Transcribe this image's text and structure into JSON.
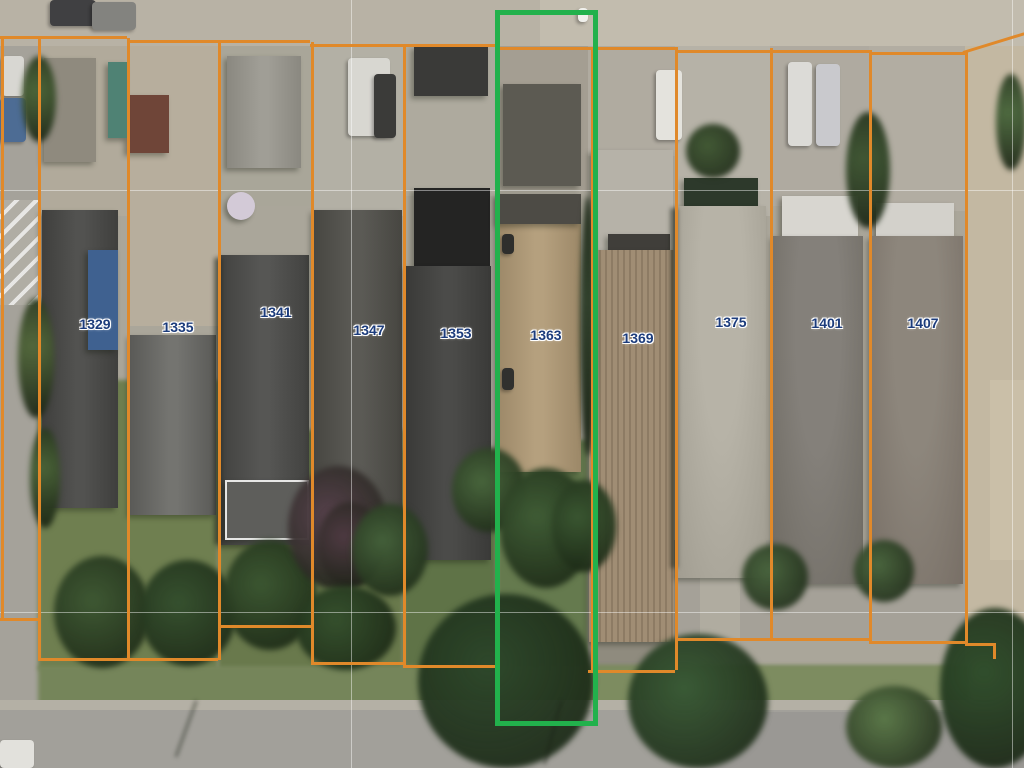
{
  "map": {
    "type": "aerial-parcel-view",
    "description": "aerial photo of residential block with parcel boundary overlay",
    "parcel_line_color": "#e0892a",
    "highlight_color": "#22b14c",
    "label_color": "#1c3c7c",
    "graticule_color": "rgba(255,255,255,0.45)",
    "highlighted_lot": "1363",
    "lots": [
      {
        "number": "1329",
        "label_x": 95,
        "label_y": 324
      },
      {
        "number": "1335",
        "label_x": 178,
        "label_y": 327
      },
      {
        "number": "1341",
        "label_x": 276,
        "label_y": 312
      },
      {
        "number": "1347",
        "label_x": 369,
        "label_y": 330
      },
      {
        "number": "1353",
        "label_x": 456,
        "label_y": 333
      },
      {
        "number": "1363",
        "label_x": 546,
        "label_y": 335
      },
      {
        "number": "1369",
        "label_x": 638,
        "label_y": 338
      },
      {
        "number": "1375",
        "label_x": 731,
        "label_y": 322
      },
      {
        "number": "1401",
        "label_x": 827,
        "label_y": 323
      },
      {
        "number": "1407",
        "label_x": 923,
        "label_y": 323
      }
    ],
    "highlight_box": {
      "x": 495,
      "y": 10,
      "w": 93,
      "h": 706,
      "stroke": 5
    }
  },
  "scene": {
    "patches": [
      {
        "x": 0,
        "y": 0,
        "w": 1024,
        "h": 46,
        "c": "#b8b2a5"
      },
      {
        "x": 540,
        "y": 0,
        "w": 484,
        "h": 48,
        "c": "#c2bcae"
      },
      {
        "x": 0,
        "y": 46,
        "w": 40,
        "h": 660,
        "c": "#a5a29a"
      },
      {
        "x": 0,
        "y": 200,
        "w": 38,
        "h": 105,
        "c": "#b0ada4",
        "stripes": true
      },
      {
        "x": 965,
        "y": 46,
        "w": 59,
        "h": 700,
        "c": "#c3b8a2"
      },
      {
        "x": 990,
        "y": 380,
        "w": 34,
        "h": 180,
        "c": "#cabfa8"
      },
      {
        "x": 40,
        "y": 46,
        "w": 88,
        "h": 170,
        "c": "#b1aa9b"
      },
      {
        "x": 128,
        "y": 46,
        "w": 90,
        "h": 280,
        "c": "#b7ae9d"
      },
      {
        "x": 218,
        "y": 46,
        "w": 93,
        "h": 160,
        "c": "#a9a699"
      },
      {
        "x": 311,
        "y": 46,
        "w": 92,
        "h": 170,
        "c": "#b3b0a5"
      },
      {
        "x": 403,
        "y": 46,
        "w": 94,
        "h": 150,
        "c": "#aeaa9e"
      },
      {
        "x": 497,
        "y": 46,
        "w": 91,
        "h": 145,
        "c": "#a49e92"
      },
      {
        "x": 588,
        "y": 46,
        "w": 87,
        "h": 110,
        "c": "#b0aba0"
      },
      {
        "x": 675,
        "y": 46,
        "w": 95,
        "h": 170,
        "c": "#b6b2a7"
      },
      {
        "x": 770,
        "y": 46,
        "w": 99,
        "h": 160,
        "c": "#afaaa0"
      },
      {
        "x": 869,
        "y": 46,
        "w": 96,
        "h": 165,
        "c": "#b2ada2"
      },
      {
        "x": 38,
        "y": 380,
        "w": 180,
        "h": 290,
        "c": "#6f7f50",
        "blur": true
      },
      {
        "x": 218,
        "y": 430,
        "w": 185,
        "h": 240,
        "c": "#69794c",
        "blur": true
      },
      {
        "x": 403,
        "y": 450,
        "w": 94,
        "h": 225,
        "c": "#5f7347",
        "blur": true
      },
      {
        "x": 497,
        "y": 440,
        "w": 91,
        "h": 240,
        "c": "#657a4e",
        "blur": true
      },
      {
        "x": 588,
        "y": 540,
        "w": 87,
        "h": 140,
        "c": "#8f8b7e"
      },
      {
        "x": 675,
        "y": 540,
        "w": 290,
        "h": 100,
        "c": "#a5a198"
      },
      {
        "x": 700,
        "y": 576,
        "w": 40,
        "h": 90,
        "c": "#b0aca0"
      },
      {
        "x": 38,
        "y": 666,
        "w": 930,
        "h": 42,
        "c": "#75855a",
        "blur": true
      },
      {
        "x": 588,
        "y": 666,
        "w": 380,
        "h": 40,
        "c": "#7d8c60",
        "blur": true
      },
      {
        "x": 0,
        "y": 700,
        "w": 1024,
        "h": 12,
        "c": "#b4b0a5"
      },
      {
        "x": 0,
        "y": 710,
        "w": 1024,
        "h": 58,
        "c": "#a2a09a"
      },
      {
        "x": 700,
        "y": 712,
        "w": 324,
        "h": 56,
        "c": "#9a9894"
      }
    ],
    "houses": [
      {
        "x": 44,
        "y": 58,
        "w": 52,
        "h": 104,
        "kind": "flat",
        "c1": "#8f8a7e"
      },
      {
        "x": 42,
        "y": 210,
        "w": 76,
        "h": 298,
        "kind": "gable",
        "c1": "#525250",
        "c2": "#3f3f3d"
      },
      {
        "x": 88,
        "y": 250,
        "w": 30,
        "h": 100,
        "kind": "flat",
        "c1": "#3f6190"
      },
      {
        "x": 127,
        "y": 95,
        "w": 42,
        "h": 58,
        "kind": "flat",
        "c1": "#6f4538"
      },
      {
        "x": 108,
        "y": 62,
        "w": 20,
        "h": 76,
        "kind": "flat",
        "c1": "#4f8274"
      },
      {
        "x": 130,
        "y": 335,
        "w": 86,
        "h": 180,
        "kind": "gable",
        "c1": "#747470",
        "c2": "#5a5a57"
      },
      {
        "x": 227,
        "y": 56,
        "w": 74,
        "h": 112,
        "kind": "gable",
        "c1": "#a09e96",
        "c2": "#8a8880"
      },
      {
        "x": 220,
        "y": 255,
        "w": 89,
        "h": 290,
        "kind": "gable",
        "c1": "#565654",
        "c2": "#424240"
      },
      {
        "x": 225,
        "y": 480,
        "w": 80,
        "h": 56,
        "kind": "flat",
        "c1": "#5e5e5b",
        "border": "2px solid rgba(255,255,255,0.85)"
      },
      {
        "x": 227,
        "y": 192,
        "w": 28,
        "h": 28,
        "kind": "circle",
        "c1": "#d3cad7"
      },
      {
        "x": 313,
        "y": 210,
        "w": 89,
        "h": 342,
        "kind": "gable",
        "c1": "#5b5a55",
        "c2": "#474641"
      },
      {
        "x": 414,
        "y": 46,
        "w": 74,
        "h": 50,
        "kind": "flat",
        "c1": "#3a3a38"
      },
      {
        "x": 414,
        "y": 188,
        "w": 76,
        "h": 78,
        "kind": "flat",
        "c1": "#242423"
      },
      {
        "x": 406,
        "y": 266,
        "w": 85,
        "h": 294,
        "kind": "gable",
        "c1": "#4b4b49",
        "c2": "#3a3a38"
      },
      {
        "x": 503,
        "y": 84,
        "w": 78,
        "h": 102,
        "kind": "flat",
        "c1": "#5c5a52"
      },
      {
        "x": 497,
        "y": 194,
        "w": 84,
        "h": 278,
        "kind": "gable",
        "c1": "#b5a07e",
        "c2": "#9c8868"
      },
      {
        "x": 497,
        "y": 194,
        "w": 84,
        "h": 30,
        "kind": "flat",
        "c1": "#4d4b45"
      },
      {
        "x": 591,
        "y": 150,
        "w": 82,
        "h": 102,
        "kind": "flat",
        "c1": "#b6b2a8"
      },
      {
        "x": 608,
        "y": 234,
        "w": 62,
        "h": 20,
        "kind": "flat",
        "c1": "#403e3a"
      },
      {
        "x": 589,
        "y": 250,
        "w": 85,
        "h": 392,
        "kind": "ribbed",
        "c1": "#a08d74",
        "c2": "#8d7b64"
      },
      {
        "x": 684,
        "y": 178,
        "w": 74,
        "h": 30,
        "kind": "flat",
        "c1": "#2d392b"
      },
      {
        "x": 677,
        "y": 206,
        "w": 89,
        "h": 372,
        "kind": "hip",
        "c1": "#b7b3a7",
        "c2": "#a19d91"
      },
      {
        "x": 782,
        "y": 196,
        "w": 76,
        "h": 42,
        "kind": "flat",
        "c1": "#d8d6d0"
      },
      {
        "x": 773,
        "y": 236,
        "w": 90,
        "h": 348,
        "kind": "hip",
        "c1": "#84807a",
        "c2": "#6f6b63"
      },
      {
        "x": 876,
        "y": 203,
        "w": 78,
        "h": 36,
        "kind": "flat",
        "c1": "#d3d1cb"
      },
      {
        "x": 870,
        "y": 236,
        "w": 93,
        "h": 348,
        "kind": "hip",
        "c1": "#8d867c",
        "c2": "#786f66"
      }
    ],
    "vehicles": [
      {
        "x": 50,
        "y": 0,
        "w": 46,
        "h": 26,
        "c": "#404042"
      },
      {
        "x": 92,
        "y": 2,
        "w": 44,
        "h": 28,
        "c": "#83837f"
      },
      {
        "x": 2,
        "y": 56,
        "w": 22,
        "h": 40,
        "c": "#d8d7d2"
      },
      {
        "x": 0,
        "y": 98,
        "w": 26,
        "h": 44,
        "c": "#4d6c94"
      },
      {
        "x": 348,
        "y": 58,
        "w": 42,
        "h": 78,
        "c": "#d8d7d1"
      },
      {
        "x": 374,
        "y": 74,
        "w": 22,
        "h": 64,
        "c": "#3b3b39"
      },
      {
        "x": 656,
        "y": 70,
        "w": 26,
        "h": 70,
        "c": "#e4e3dd"
      },
      {
        "x": 788,
        "y": 62,
        "w": 24,
        "h": 84,
        "c": "#dcdbd7"
      },
      {
        "x": 816,
        "y": 64,
        "w": 24,
        "h": 82,
        "c": "#c9c9cd"
      },
      {
        "x": 0,
        "y": 740,
        "w": 34,
        "h": 28,
        "c": "#e2e1dc"
      },
      {
        "x": 502,
        "y": 234,
        "w": 12,
        "h": 20,
        "c": "#2e2e2c"
      },
      {
        "x": 502,
        "y": 368,
        "w": 12,
        "h": 22,
        "c": "#30302e"
      },
      {
        "x": 578,
        "y": 8,
        "w": 10,
        "h": 14,
        "c": "#f0f0ec"
      }
    ],
    "trees": [
      {
        "x": 22,
        "y": 56,
        "w": 34,
        "h": 86,
        "c": "#4c6539"
      },
      {
        "x": 18,
        "y": 298,
        "w": 36,
        "h": 120,
        "c": "#53683c"
      },
      {
        "x": 30,
        "y": 428,
        "w": 30,
        "h": 100,
        "c": "#4a6338"
      },
      {
        "x": 54,
        "y": 556,
        "w": 96,
        "h": 112,
        "c": "#3e5833"
      },
      {
        "x": 140,
        "y": 560,
        "w": 96,
        "h": 106,
        "c": "#36512f"
      },
      {
        "x": 224,
        "y": 540,
        "w": 92,
        "h": 110,
        "c": "#3b5631"
      },
      {
        "x": 288,
        "y": 466,
        "w": 100,
        "h": 124,
        "c": "#56414b"
      },
      {
        "x": 318,
        "y": 502,
        "w": 64,
        "h": 86,
        "c": "#4e3a42"
      },
      {
        "x": 352,
        "y": 504,
        "w": 76,
        "h": 92,
        "c": "#44603a"
      },
      {
        "x": 296,
        "y": 586,
        "w": 100,
        "h": 84,
        "c": "#35502d"
      },
      {
        "x": 452,
        "y": 448,
        "w": 74,
        "h": 84,
        "c": "#48653c"
      },
      {
        "x": 500,
        "y": 468,
        "w": 92,
        "h": 120,
        "c": "#3f5c35"
      },
      {
        "x": 552,
        "y": 480,
        "w": 64,
        "h": 92,
        "c": "#3a5631"
      },
      {
        "x": 418,
        "y": 594,
        "w": 176,
        "h": 174,
        "c": "#2e482b"
      },
      {
        "x": 628,
        "y": 634,
        "w": 140,
        "h": 134,
        "c": "#3a5a36"
      },
      {
        "x": 686,
        "y": 124,
        "w": 54,
        "h": 54,
        "c": "#425935"
      },
      {
        "x": 742,
        "y": 544,
        "w": 66,
        "h": 66,
        "c": "#49643e"
      },
      {
        "x": 846,
        "y": 112,
        "w": 44,
        "h": 116,
        "c": "#405734"
      },
      {
        "x": 854,
        "y": 540,
        "w": 60,
        "h": 62,
        "c": "#4a653e"
      },
      {
        "x": 940,
        "y": 608,
        "w": 110,
        "h": 160,
        "c": "#304e2c"
      },
      {
        "x": 846,
        "y": 686,
        "w": 96,
        "h": 82,
        "c": "#5a7748"
      },
      {
        "x": 996,
        "y": 74,
        "w": 30,
        "h": 96,
        "c": "#4e6a40"
      },
      {
        "x": 580,
        "y": 196,
        "w": 16,
        "h": 260,
        "c": "#31402c"
      }
    ],
    "shadows": [
      {
        "x": 195,
        "y": 700,
        "w": 3,
        "h": 60,
        "rot": 20
      },
      {
        "x": 560,
        "y": 700,
        "w": 3,
        "h": 66,
        "rot": 15
      },
      {
        "x": 214,
        "y": 258,
        "w": 8,
        "h": 286,
        "rot": 0
      },
      {
        "x": 670,
        "y": 208,
        "w": 8,
        "h": 360,
        "rot": 0
      }
    ],
    "graticule": [
      {
        "x": 0,
        "y": 190,
        "w": 1024,
        "h": 1
      },
      {
        "x": 0,
        "y": 612,
        "w": 1024,
        "h": 1
      },
      {
        "x": 351,
        "y": 0,
        "w": 1,
        "h": 768
      },
      {
        "x": 1012,
        "y": 0,
        "w": 1,
        "h": 768
      }
    ],
    "boundaries": {
      "h": [
        {
          "x": 0,
          "y": 36,
          "w": 127
        },
        {
          "x": 127,
          "y": 40,
          "w": 183
        },
        {
          "x": 310,
          "y": 44,
          "w": 185
        },
        {
          "x": 495,
          "y": 47,
          "w": 180
        },
        {
          "x": 675,
          "y": 50,
          "w": 194
        },
        {
          "x": 869,
          "y": 52,
          "w": 96
        },
        {
          "x": 0,
          "y": 618,
          "w": 40
        },
        {
          "x": 38,
          "y": 658,
          "w": 180
        },
        {
          "x": 218,
          "y": 625,
          "w": 93
        },
        {
          "x": 311,
          "y": 662,
          "w": 92
        },
        {
          "x": 403,
          "y": 665,
          "w": 94
        },
        {
          "x": 588,
          "y": 670,
          "w": 87
        },
        {
          "x": 675,
          "y": 638,
          "w": 194
        },
        {
          "x": 869,
          "y": 641,
          "w": 96
        },
        {
          "x": 965,
          "y": 643,
          "w": 30
        }
      ],
      "v": [
        {
          "x": 1,
          "y": 36,
          "h": 584
        },
        {
          "x": 38,
          "y": 36,
          "h": 624
        },
        {
          "x": 127,
          "y": 38,
          "h": 622
        },
        {
          "x": 218,
          "y": 40,
          "h": 620
        },
        {
          "x": 311,
          "y": 42,
          "h": 622
        },
        {
          "x": 403,
          "y": 44,
          "h": 623
        },
        {
          "x": 591,
          "y": 47,
          "h": 625
        },
        {
          "x": 675,
          "y": 47,
          "h": 623
        },
        {
          "x": 770,
          "y": 48,
          "h": 592
        },
        {
          "x": 869,
          "y": 50,
          "h": 592
        },
        {
          "x": 965,
          "y": 52,
          "h": 593
        },
        {
          "x": 993,
          "y": 643,
          "h": 16
        }
      ],
      "diag": [
        {
          "x": 963,
          "y": 51,
          "len": 64,
          "rot": -17
        }
      ]
    }
  }
}
